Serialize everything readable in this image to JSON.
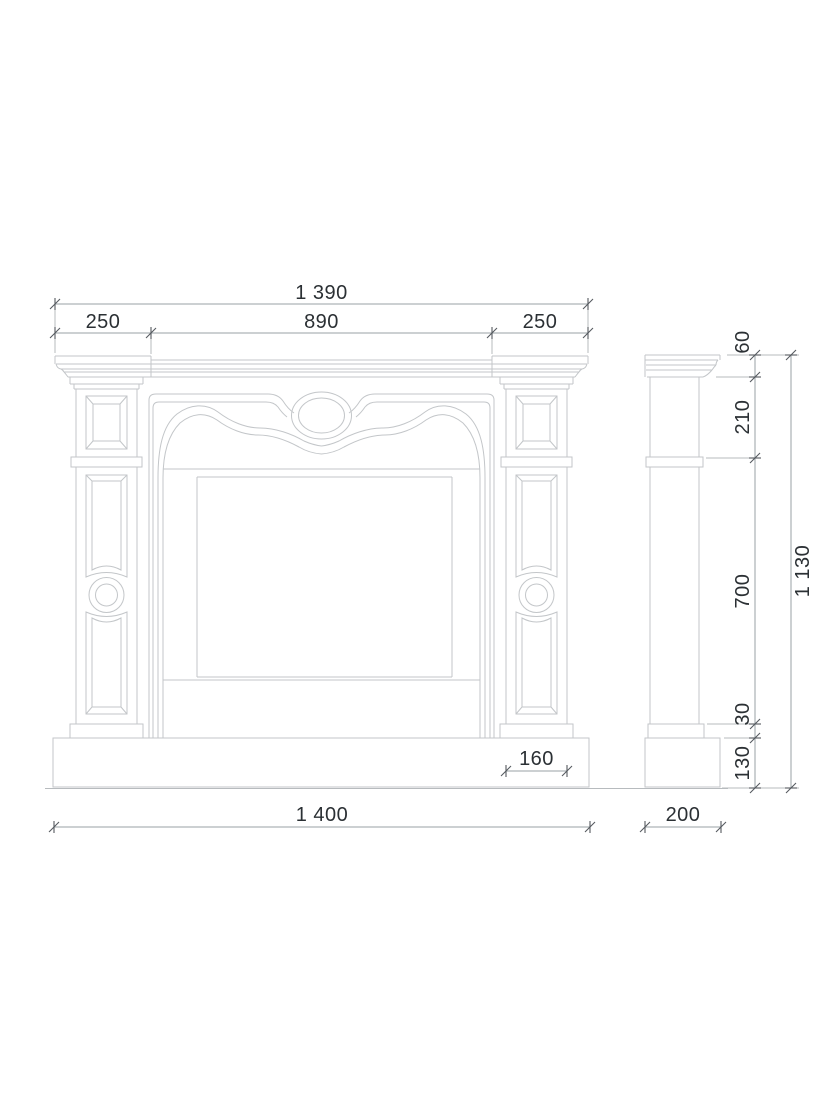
{
  "drawing": {
    "type": "fireplace-mantel-dimensional-drawing",
    "views": [
      "front",
      "side"
    ]
  },
  "dims": {
    "top_total": "1 390",
    "top_left": "250",
    "top_center": "890",
    "top_right": "250",
    "side_shelf": "60",
    "side_frieze": "210",
    "side_leg": "700",
    "side_base_step": "30",
    "side_plinth": "130",
    "side_total": "1 130",
    "pilaster_width": "160",
    "bottom_front": "1 400",
    "bottom_side": "200"
  },
  "colors": {
    "background": "#ffffff",
    "object_line": "#c3c6c9",
    "dim_line": "#9aa0a4",
    "ext_line": "#b7bbbe",
    "tick": "#555a5f",
    "text": "#2b3034"
  }
}
